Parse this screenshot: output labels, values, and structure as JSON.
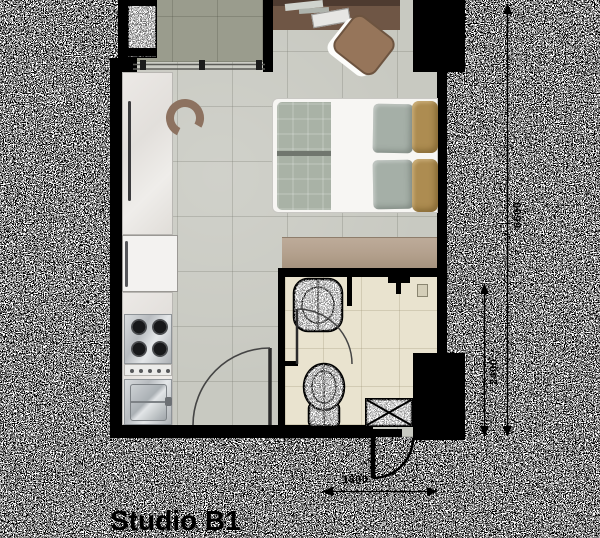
{
  "plan": {
    "title": "Studio B1",
    "dimensions": {
      "total_depth": "6600",
      "entry_depth": "2400",
      "entry_width": "1800"
    },
    "rooms": [
      "balcony",
      "living-bedroom",
      "kitchen",
      "bathroom",
      "entry"
    ],
    "fixtures": [
      "sliding-door",
      "ac-unit",
      "desk",
      "desk-chair",
      "bar-stool",
      "kitchen-counter",
      "refrigerator",
      "stove",
      "kitchen-sink",
      "double-bed",
      "wardrobe",
      "washbasin",
      "toilet",
      "shower-head",
      "floor-drain",
      "service-shaft",
      "entrance-door"
    ],
    "colors": {
      "wall": "#000000",
      "living_floor": "#c8c9c1",
      "balcony_floor": "#9a9c8d",
      "bathroom_floor": "#e9e3cf",
      "wardrobe": "#b4a18e",
      "desk": "#6f5645",
      "duvet": "#a9b2a6",
      "accent_pillow": "#ad8c51",
      "background_noise": "#000000 / #ffffff"
    }
  }
}
